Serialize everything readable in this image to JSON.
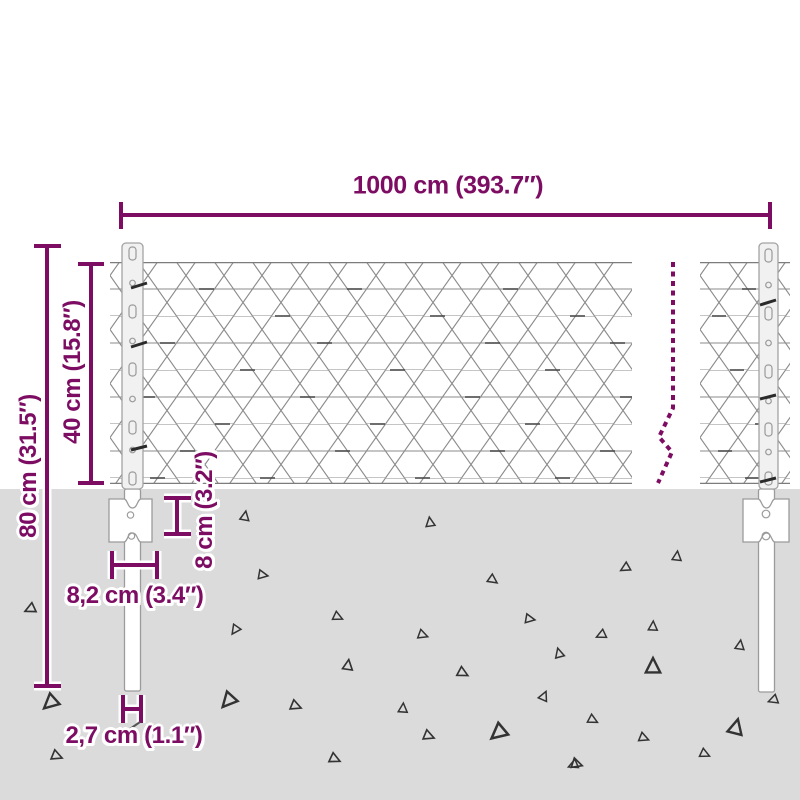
{
  "colors": {
    "accent": "#7d0c63",
    "ground": "#dbdbdb",
    "wire": "#8b8b8b"
  },
  "dimensions": {
    "total_width": {
      "label": "1000 cm (393.7″)",
      "cm": 1000,
      "inches": 393.7
    },
    "total_height": {
      "label": "80 cm (31.5″)",
      "cm": 80,
      "inches": 31.5
    },
    "mesh_height": {
      "label": "40 cm (15.8″)",
      "cm": 40,
      "inches": 15.8
    },
    "anchor_depth": {
      "label": "8 cm (3.2″)",
      "cm": 8,
      "inches": 3.2
    },
    "anchor_width": {
      "label": "8,2 cm (3.4″)",
      "cm": 8.2,
      "inches": 3.4
    },
    "post_width": {
      "label": "2,7 cm (1.1″)",
      "cm": 2.7,
      "inches": 1.1
    }
  }
}
